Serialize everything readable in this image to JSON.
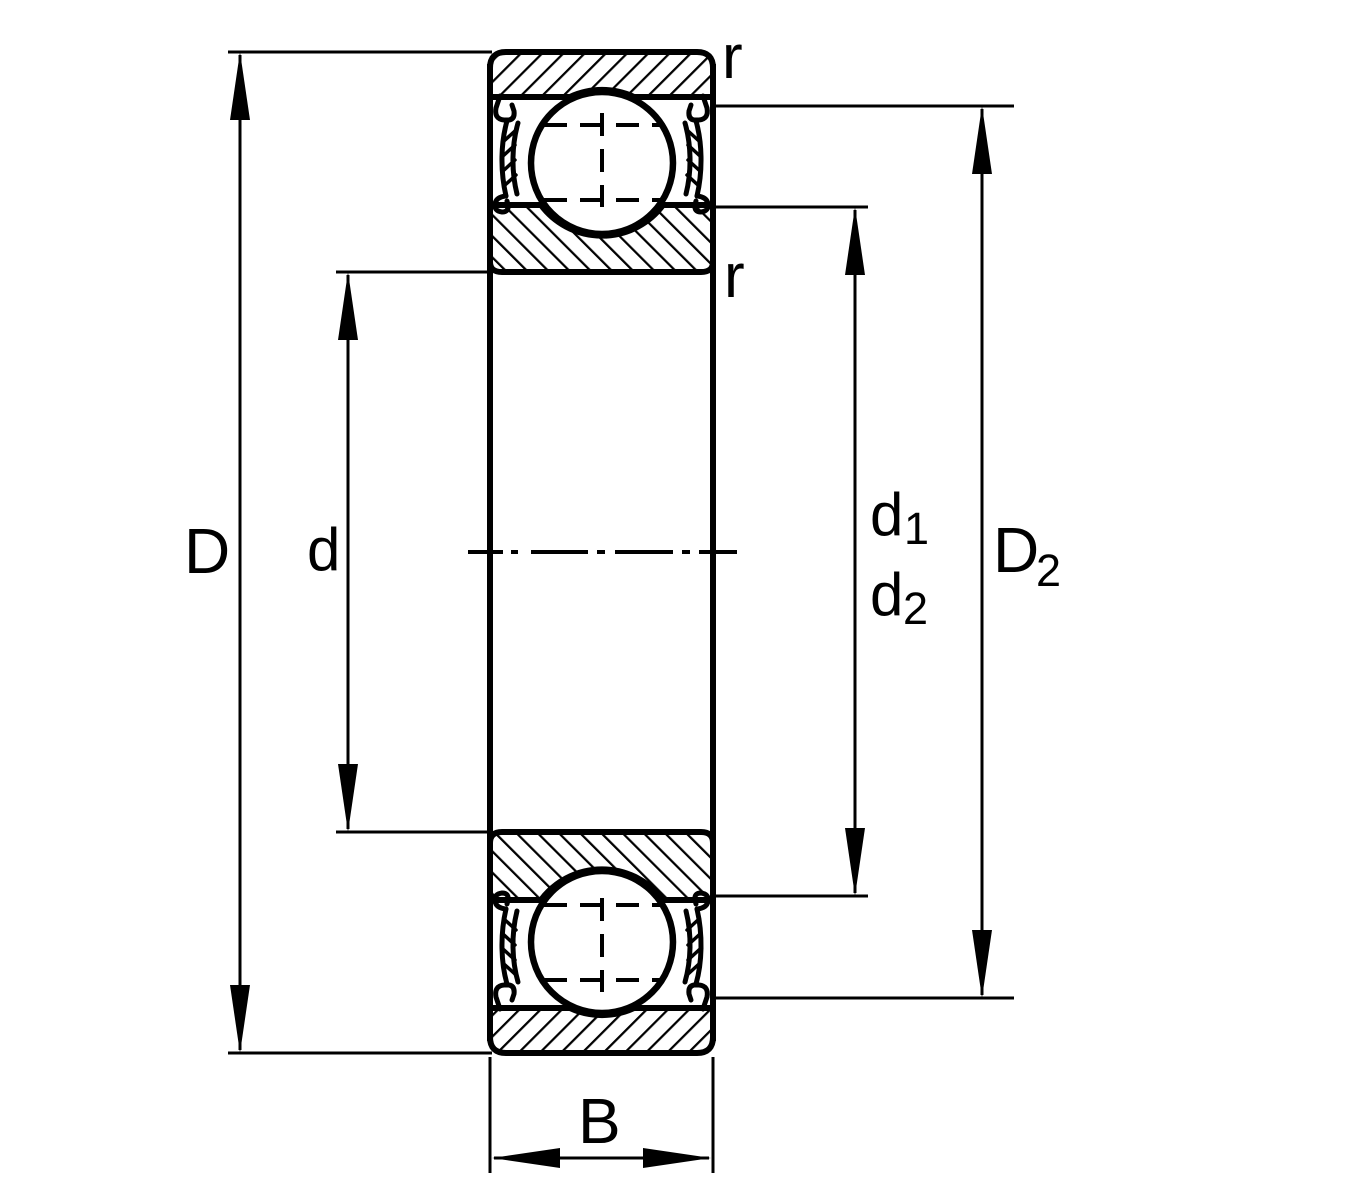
{
  "drawing": {
    "subject": "shielded deep groove ball bearing cross-section",
    "background_color": "#ffffff",
    "line_color": "#000000",
    "labels": {
      "outer_diameter": "D",
      "bore_diameter": "d",
      "shoulder_d1": {
        "base": "d",
        "sub": "1"
      },
      "shoulder_d2": {
        "base": "d",
        "sub": "2"
      },
      "recess_D2": {
        "base": "D",
        "sub": "2"
      },
      "width": "B",
      "chamfer_outer": "r",
      "chamfer_inner": "r"
    }
  }
}
